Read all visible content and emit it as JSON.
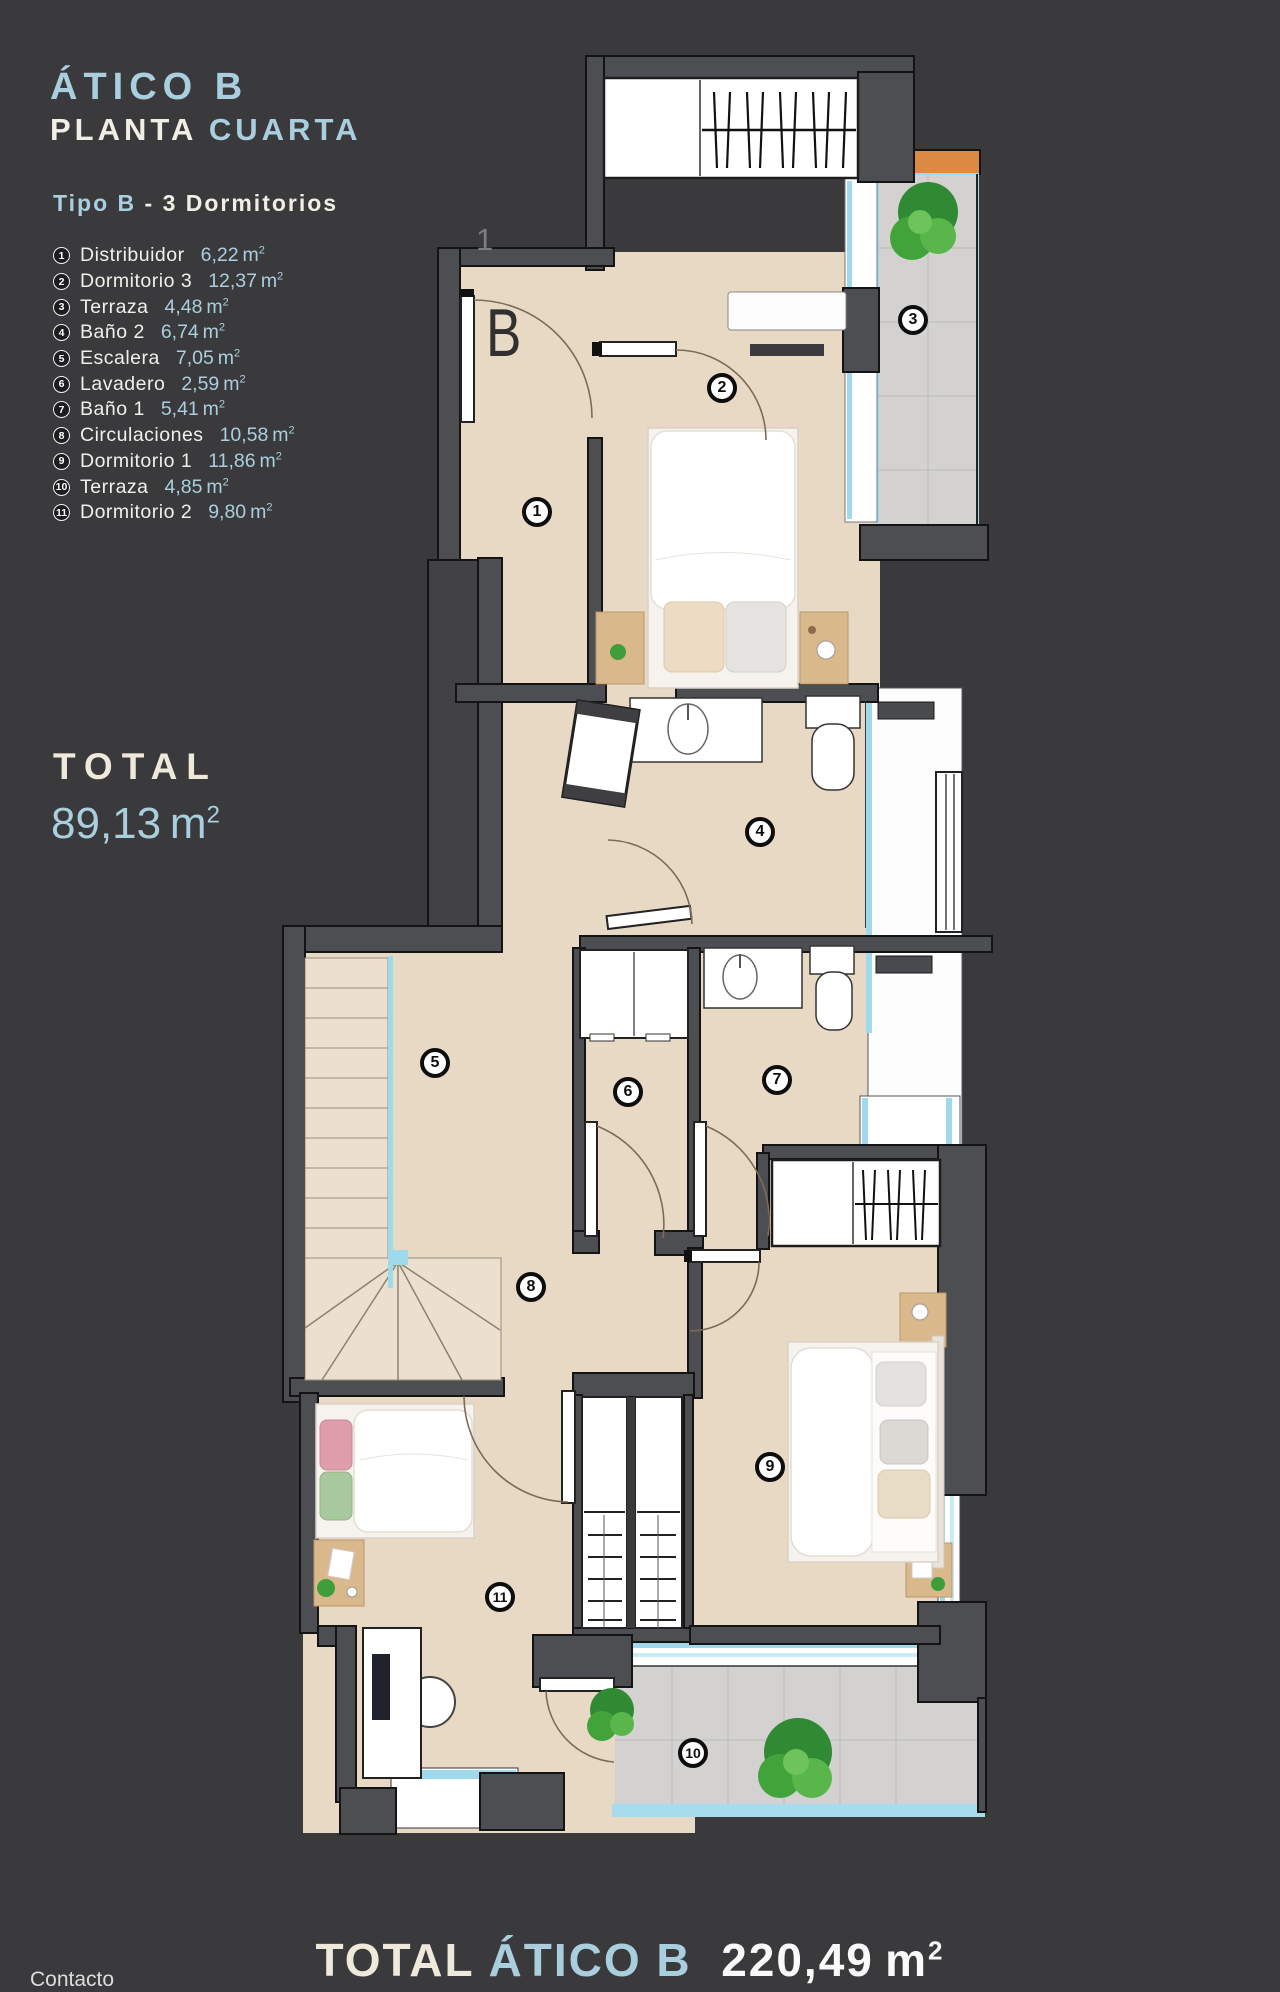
{
  "header": {
    "title": "ÁTICO B",
    "subtitle_white": "PLANTA",
    "subtitle_accent": "CUARTA",
    "type_accent": "Tipo B",
    "type_rest": "- 3 Dormitorios"
  },
  "legend": {
    "unit": "m",
    "sup": "2",
    "items": [
      {
        "num": "1",
        "label": "Distribuidor",
        "value": "6,22"
      },
      {
        "num": "2",
        "label": "Dormitorio 3",
        "value": "12,37"
      },
      {
        "num": "3",
        "label": "Terraza",
        "value": "4,48"
      },
      {
        "num": "4",
        "label": "Baño 2",
        "value": "6,74"
      },
      {
        "num": "5",
        "label": "Escalera",
        "value": "7,05"
      },
      {
        "num": "6",
        "label": "Lavadero",
        "value": "2,59"
      },
      {
        "num": "7",
        "label": "Baño 1",
        "value": "5,41"
      },
      {
        "num": "8",
        "label": "Circulaciones",
        "value": "10,58"
      },
      {
        "num": "9",
        "label": "Dormitorio 1",
        "value": "11,86"
      },
      {
        "num": "10",
        "label": "Terraza",
        "value": "4,85"
      },
      {
        "num": "11",
        "label": "Dormitorio 2",
        "value": "9,80"
      }
    ]
  },
  "total": {
    "label": "TOTAL",
    "value": "89,13",
    "unit": "m",
    "sup": "2"
  },
  "footer": {
    "total_label": "TOTAL",
    "total_accent": "ÁTICO B",
    "total_value": "220,49",
    "unit": "m",
    "sup": "2",
    "contact": "Contacto"
  },
  "plan": {
    "block_letter": "B",
    "stray_mark": "1",
    "room_numbers": [
      "1",
      "2",
      "3",
      "4",
      "5",
      "6",
      "7",
      "8",
      "9",
      "10",
      "11"
    ]
  },
  "colors": {
    "accent_blue": "#a9cfdf",
    "background": "#3a3a3c",
    "floor_beige": "#e8d9c4",
    "wall_gray": "#4d4e52",
    "tile_gray": "#d3d2d0",
    "window_cyan": "#9fd9ec",
    "terrace_orange": "#db8a43",
    "plant_green": "#3f9e39"
  }
}
